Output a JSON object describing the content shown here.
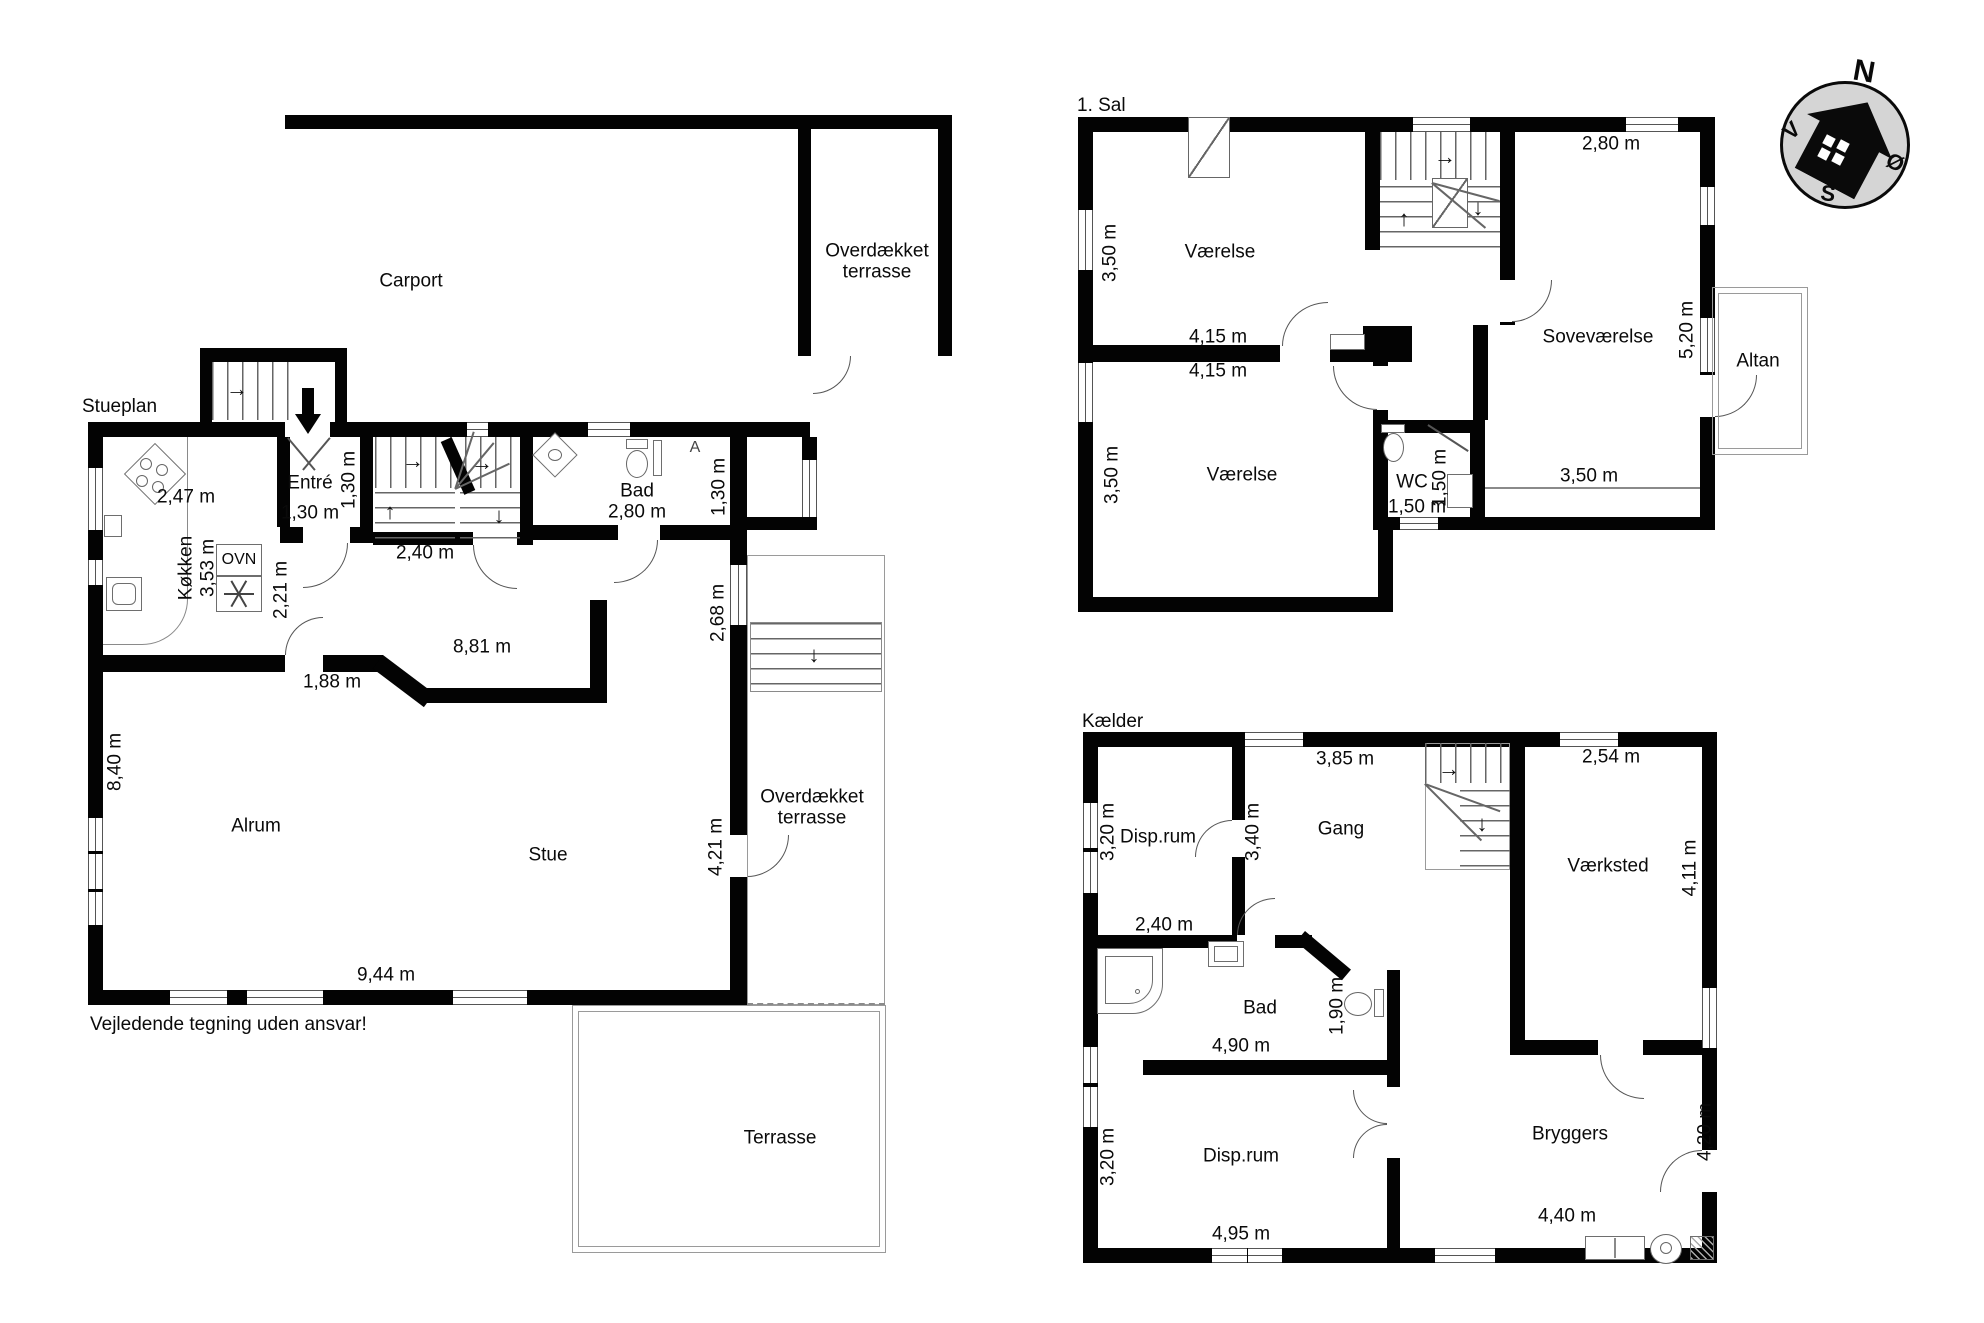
{
  "meta": {
    "disclaimer": "Vejledende tegning uden ansvar!"
  },
  "compass": {
    "north": "N",
    "west": "V",
    "east": "Ø",
    "south": "S"
  },
  "stueplan": {
    "title": "Stueplan",
    "carport": "Carport",
    "covered_terrace_ne": "Overdækket terrasse",
    "covered_terrace_e": "Overdækket terrasse",
    "terrace": "Terrasse",
    "entre": "Entré",
    "entre_width": "1,30 m",
    "entre_depth": "1,30 m",
    "kitchen": "Køkken",
    "kitchen_length": "3,53 m",
    "kitchen_width": "2,47 m",
    "oven": "OVN",
    "hall_width": "2,21 m",
    "stairs_width": "2,40 m",
    "bath": "Bad",
    "bath_width": "2,80 m",
    "bath_depth": "1,30 m",
    "east_width": "2,68 m",
    "opening_width": "8,81 m",
    "kitchen_opening": "1,88 m",
    "family_room": "Alrum",
    "west_length": "8,40 m",
    "living_room": "Stue",
    "terrace_door_width": "4,21 m",
    "south_length": "9,44 m",
    "drain_symbol": "A"
  },
  "first_floor": {
    "title": "1. Sal",
    "room_nw": "Værelse",
    "room_nw_depth": "3,50 m",
    "room_sw": "Værelse",
    "room_sw_depth": "3,50 m",
    "mid_width_top": "4,15 m",
    "mid_width_bottom": "4,15 m",
    "wc": "WC",
    "wc_width": "1,50 m",
    "wc_depth": "1,50 m",
    "bedroom": "Soveværelse",
    "bedroom_width": "2,80 m",
    "bedroom_length": "5,20 m",
    "bedroom_south": "3,50 m",
    "balcony": "Altan"
  },
  "basement": {
    "title": "Kælder",
    "storage_n": "Disp.rum",
    "storage_n_depth": "3,20 m",
    "storage_n_width": "2,40 m",
    "hall": "Gang",
    "hall_width": "3,85 m",
    "hall_depth": "3,40 m",
    "workshop": "Værksted",
    "workshop_width": "2,54 m",
    "workshop_depth": "4,11 m",
    "bath": "Bad",
    "bath_width": "4,90 m",
    "bath_depth": "1,90 m",
    "storage_s": "Disp.rum",
    "storage_s_depth": "3,20 m",
    "storage_s_width": "4,95 m",
    "utility": "Bryggers",
    "utility_width": "4,40 m",
    "utility_depth": "4,20 m"
  }
}
